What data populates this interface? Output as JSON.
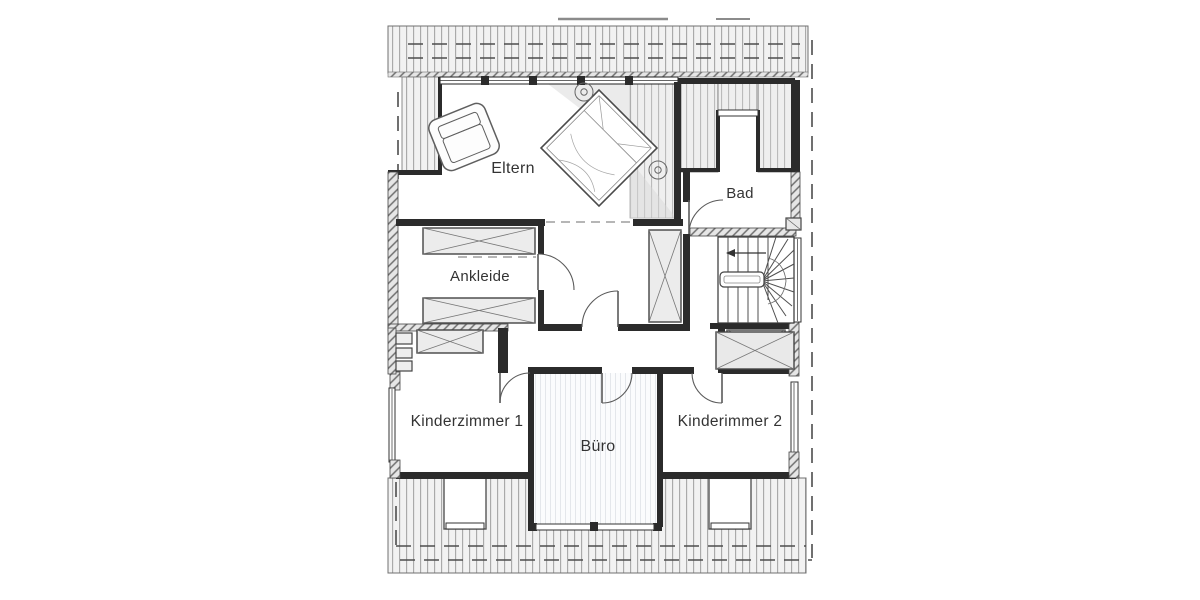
{
  "plan": {
    "type": "floor-plan",
    "storey": "attic",
    "rooms": {
      "eltern": {
        "label": "Eltern"
      },
      "bad": {
        "label": "Bad"
      },
      "ankleide": {
        "label": "Ankleide"
      },
      "kinderzimmer1": {
        "label": "Kinderzimmer 1"
      },
      "buero": {
        "label": "Büro"
      },
      "kinderimmer2": {
        "label": "Kinderimmer 2"
      }
    },
    "symbols": {
      "stairs": "stairs-with-down-arrow",
      "bed": "double-bed-rotated-45",
      "armchair": "armchair",
      "wardrobes": "crossed-box",
      "downlights": 2
    },
    "colors": {
      "paper": "#ffffff",
      "wall": "#2b2b2b",
      "roof_stripe": "#a6a6a6",
      "roof_fill": "#f2f2f2",
      "furniture_line": "#5a5a5a",
      "text": "#333333"
    }
  }
}
